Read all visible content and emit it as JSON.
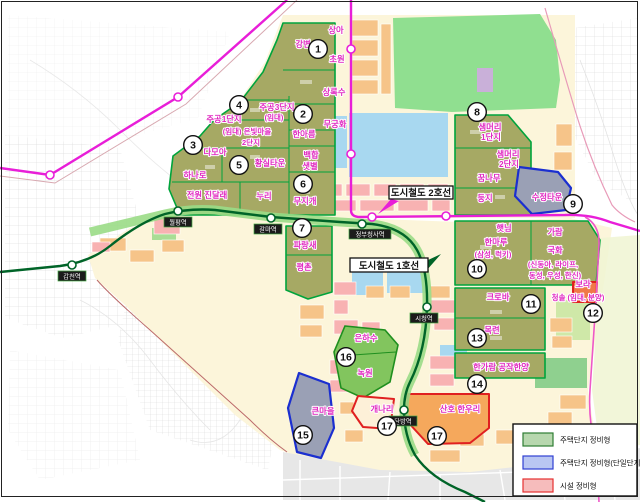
{
  "map": {
    "colors": {
      "line1": "#006428",
      "line1_band": "#9adb86",
      "line2": "#e81ed8",
      "zone_housing_fill": "#a6a964",
      "zone_housing_border": "#00a43c",
      "zone_single_fill": "#9aa0b5",
      "zone_single_border": "#1b2fd0",
      "zone_facility_border": "#e02020",
      "label_pink": "#e028c0",
      "water": "#a8d8f0",
      "park": "#90df90",
      "urban_cream": "#fcf5da",
      "block_orange": "#f6c489",
      "block_pink": "#f8b2b2"
    },
    "lines": {
      "line2": {
        "label": "도시철도 2호선"
      },
      "line1": {
        "label": "도시철도 1호선"
      }
    },
    "legend": {
      "items": [
        {
          "label": "주택단지 정비형",
          "fill": "#b7d7ae",
          "border": "#2e7d32"
        },
        {
          "label": "주택단지 정비형(단일단지)",
          "fill": "#b9c6f2",
          "border": "#2f3fd3"
        },
        {
          "label": "시설 정비형",
          "fill": "#f6bcbc",
          "border": "#e53030"
        }
      ]
    },
    "markers": [
      {
        "n": "1",
        "x": 318,
        "y": 49
      },
      {
        "n": "2",
        "x": 303,
        "y": 114
      },
      {
        "n": "3",
        "x": 193,
        "y": 145
      },
      {
        "n": "4",
        "x": 239,
        "y": 105
      },
      {
        "n": "5",
        "x": 239,
        "y": 165
      },
      {
        "n": "6",
        "x": 303,
        "y": 184
      },
      {
        "n": "7",
        "x": 302,
        "y": 228
      },
      {
        "n": "8",
        "x": 477,
        "y": 112
      },
      {
        "n": "9",
        "x": 573,
        "y": 204
      },
      {
        "n": "10",
        "x": 477,
        "y": 269
      },
      {
        "n": "11",
        "x": 531,
        "y": 304
      },
      {
        "n": "12",
        "x": 593,
        "y": 313
      },
      {
        "n": "13",
        "x": 477,
        "y": 338
      },
      {
        "n": "14",
        "x": 477,
        "y": 384
      },
      {
        "n": "15",
        "x": 303,
        "y": 435
      },
      {
        "n": "16",
        "x": 346,
        "y": 357
      },
      {
        "n": "17",
        "x": 387,
        "y": 426
      },
      {
        "n": "17",
        "x": 437,
        "y": 436
      }
    ],
    "area_labels": [
      {
        "t": "상아",
        "x": 336,
        "y": 33
      },
      {
        "t": "강변",
        "x": 303,
        "y": 47
      },
      {
        "t": "초원",
        "x": 337,
        "y": 62
      },
      {
        "t": "상록수",
        "x": 334,
        "y": 95
      },
      {
        "t": "주공3단지",
        "x": 277,
        "y": 110
      },
      {
        "t": "(임대)",
        "x": 274,
        "y": 120,
        "s": 7.5
      },
      {
        "t": "무궁화",
        "x": 335,
        "y": 127
      },
      {
        "t": "주공1단지",
        "x": 224,
        "y": 122
      },
      {
        "t": "(임대) 은빛마을",
        "x": 247,
        "y": 134,
        "s": 7.5
      },
      {
        "t": "2단지",
        "x": 251,
        "y": 145,
        "s": 7.5
      },
      {
        "t": "한아름",
        "x": 304,
        "y": 137
      },
      {
        "t": "다모아",
        "x": 215,
        "y": 155
      },
      {
        "t": "백합",
        "x": 311,
        "y": 158
      },
      {
        "t": "샛별",
        "x": 310,
        "y": 169
      },
      {
        "t": "황실타운",
        "x": 270,
        "y": 166
      },
      {
        "t": "하나로",
        "x": 195,
        "y": 178
      },
      {
        "t": "전원 진달래",
        "x": 207,
        "y": 198
      },
      {
        "t": "누리",
        "x": 264,
        "y": 199
      },
      {
        "t": "무지개",
        "x": 305,
        "y": 204
      },
      {
        "t": "파랑새",
        "x": 305,
        "y": 248
      },
      {
        "t": "평촌",
        "x": 304,
        "y": 270
      },
      {
        "t": "샘머리",
        "x": 490,
        "y": 130
      },
      {
        "t": "1단지",
        "x": 491,
        "y": 140
      },
      {
        "t": "샘머리",
        "x": 508,
        "y": 157
      },
      {
        "t": "2단지",
        "x": 509,
        "y": 167
      },
      {
        "t": "꿈나무",
        "x": 489,
        "y": 181
      },
      {
        "t": "둥지",
        "x": 485,
        "y": 201
      },
      {
        "t": "수정타운",
        "x": 547,
        "y": 200
      },
      {
        "t": "햇님",
        "x": 504,
        "y": 231
      },
      {
        "t": "한마루",
        "x": 496,
        "y": 245
      },
      {
        "t": "(삼성, 럭키)",
        "x": 493,
        "y": 257,
        "s": 7.5
      },
      {
        "t": "가람",
        "x": 555,
        "y": 235
      },
      {
        "t": "국화",
        "x": 555,
        "y": 253
      },
      {
        "t": "(신동아, 라이프,",
        "x": 553,
        "y": 267,
        "s": 7.5
      },
      {
        "t": "동성, 우성, 한신)",
        "x": 555,
        "y": 278,
        "s": 7.5
      },
      {
        "t": "보라",
        "x": 583,
        "y": 287
      },
      {
        "t": "청솔 (임대, 분양)",
        "x": 578,
        "y": 300,
        "s": 7.5
      },
      {
        "t": "크로바",
        "x": 498,
        "y": 300
      },
      {
        "t": "목련",
        "x": 492,
        "y": 333
      },
      {
        "t": "한가람 공작한양",
        "x": 501,
        "y": 370
      },
      {
        "t": "은하수",
        "x": 366,
        "y": 341
      },
      {
        "t": "녹원",
        "x": 365,
        "y": 376
      },
      {
        "t": "큰마을",
        "x": 323,
        "y": 414
      },
      {
        "t": "개나리",
        "x": 382,
        "y": 412
      },
      {
        "t": "산호  한우리",
        "x": 460,
        "y": 412
      }
    ],
    "stations_line1": [
      {
        "name": "갑천역",
        "cx": 72,
        "cy": 265,
        "bx": 58,
        "by": 271,
        "bw": 28
      },
      {
        "name": "월평역",
        "cx": 178,
        "cy": 211,
        "bx": 164,
        "by": 217,
        "bw": 28
      },
      {
        "name": "갈마역",
        "cx": 271,
        "cy": 218,
        "bx": 254,
        "by": 224,
        "bw": 28
      },
      {
        "name": "정부청사역",
        "cx": 362,
        "cy": 224,
        "bx": 349,
        "by": 229,
        "bw": 42
      },
      {
        "name": "시청역",
        "cx": 427,
        "cy": 307,
        "bx": 410,
        "by": 313,
        "bw": 28
      },
      {
        "name": "탄방역",
        "cx": 404,
        "cy": 410,
        "bx": 389,
        "by": 416,
        "bw": 28
      }
    ],
    "stations_line2": [
      {
        "cx": 351,
        "cy": 49
      },
      {
        "cx": 351,
        "cy": 154
      },
      {
        "cx": 372,
        "cy": 217
      },
      {
        "cx": 446,
        "cy": 216
      }
    ],
    "stations_rail": [
      {
        "cx": 178,
        "cy": 97
      },
      {
        "cx": 50,
        "cy": 175
      }
    ]
  }
}
